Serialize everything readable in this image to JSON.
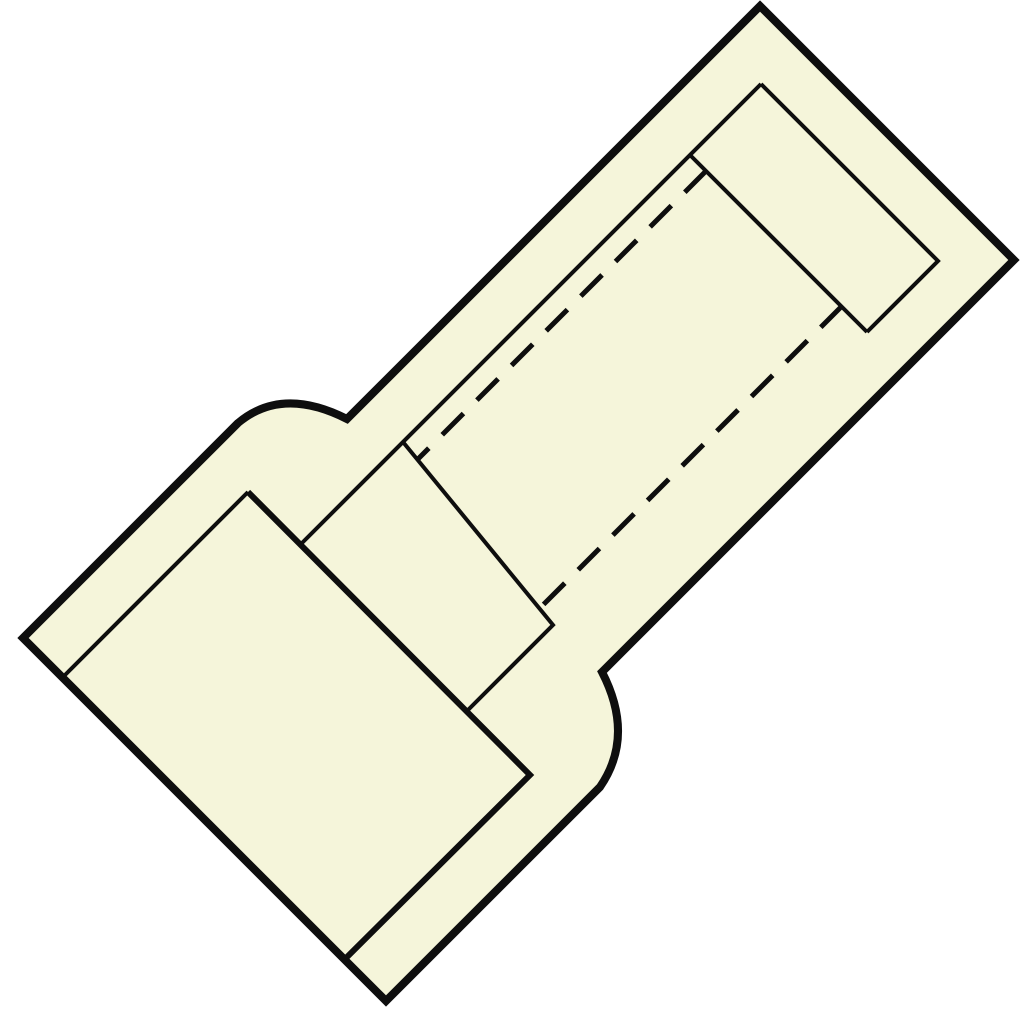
{
  "figure": {
    "description": "Technical product line drawing of an insulated crimp butt connector, shown diagonally (rotated ~45 degrees), with a flared insulation sleeve at the lower-left end, an inset barrel-entry rectangle at the upper-right end, and dashed lines indicating the hidden internal bore.",
    "background_color": "#ffffff",
    "body_fill_color": "#f5f5da",
    "line_color": "#0e0e0e",
    "dash_pattern": "30 19",
    "canvas": {
      "width": 1024,
      "height": 1024
    },
    "shapes": [
      {
        "name": "connector-body-silhouette",
        "kind": "filled-outline",
        "path": "M 760 6 L 1014 260 L 602 672 Q 635 736 600 787 L 386 1001 L 23 638 L 238 423 Q 282 386 347 419 Z",
        "stroke_width": 8,
        "dashed": false,
        "filled": true
      },
      {
        "name": "sleeve-end-face-outer-edge",
        "kind": "contour",
        "path": "M 248 492 L 530 775 L 344 960",
        "stroke_width": 6,
        "dashed": false,
        "filled": false
      },
      {
        "name": "sleeve-end-face-rim-edge",
        "kind": "contour",
        "path": "M 248 492 L 62 678",
        "stroke_width": 4,
        "dashed": false,
        "filled": false
      },
      {
        "name": "barrel-top-contour-line",
        "kind": "contour",
        "path": "M 761 84 L 299 546",
        "stroke_width": 4,
        "dashed": false,
        "filled": false
      },
      {
        "name": "barrel-entry-rectangle",
        "kind": "contour",
        "path": "M 761 84 L 938 261 L 867 332",
        "stroke_width": 4,
        "dashed": false,
        "filled": false
      },
      {
        "name": "barrel-entry-inner-step",
        "kind": "contour",
        "path": "M 690 155 L 867 332",
        "stroke_width": 4,
        "dashed": false,
        "filled": false
      },
      {
        "name": "bore-end-step-line",
        "kind": "contour",
        "path": "M 403 442 L 553 625 L 466 712",
        "stroke_width": 4,
        "dashed": false,
        "filled": false
      },
      {
        "name": "hidden-bore-upper-dashed-line",
        "kind": "hidden-edge",
        "path": "M 706 171 L 417 460",
        "stroke_width": 5,
        "dashed": true,
        "filled": false
      },
      {
        "name": "hidden-bore-lower-dashed-line",
        "kind": "hidden-edge",
        "path": "M 842 306 L 539 609",
        "stroke_width": 5,
        "dashed": true,
        "filled": false
      }
    ]
  }
}
